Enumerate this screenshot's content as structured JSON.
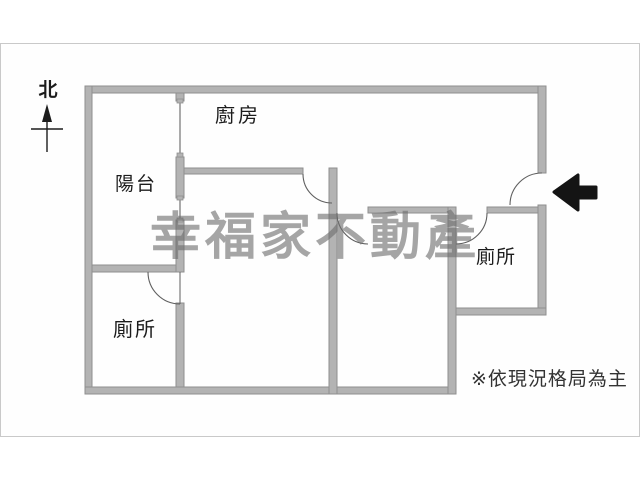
{
  "page": {
    "type": "real-estate floor plan image",
    "frame_note": "light gray photo frame border"
  },
  "compass": {
    "label": "北",
    "icon": "north-arrow-icon"
  },
  "rooms": {
    "kitchen": {
      "label": "廚房"
    },
    "balcony": {
      "label": "陽台"
    },
    "toilet_left": {
      "label": "廁所"
    },
    "toilet_right": {
      "label": "廁所"
    }
  },
  "watermark": {
    "text": "幸福家不動產"
  },
  "disclaimer": {
    "text": "※依現況格局為主"
  },
  "entrance": {
    "icon": "entrance-arrow-icon",
    "direction": "left"
  },
  "colors": {
    "wall_fill": "#b3b3b3",
    "wall_edge": "#8f8f8f",
    "door_arc": "#5f5f5f",
    "frame_border": "#c9c9c9",
    "watermark": "rgba(110,110,110,0.62)",
    "text_main": "#1c1c1c",
    "text_muted": "#333333",
    "arrow": "#141414",
    "background": "#ffffff"
  }
}
